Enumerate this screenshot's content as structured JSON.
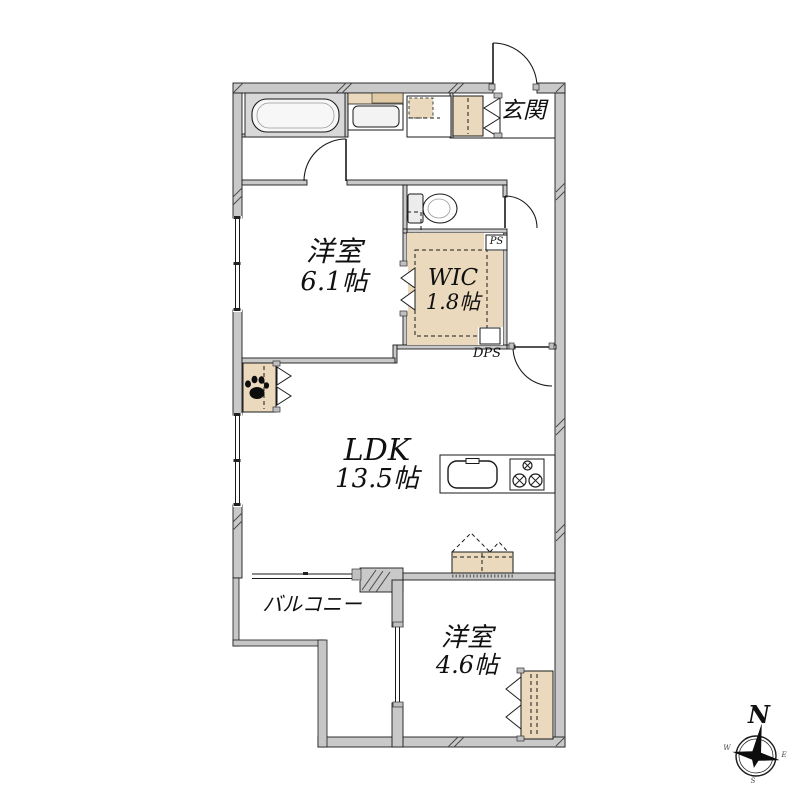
{
  "plan": {
    "type": "apartment-floor-plan",
    "entrance": {
      "label": "玄関"
    },
    "rooms": [
      {
        "id": "bedroom-1",
        "name": "洋室",
        "size": "6.1帖"
      },
      {
        "id": "walk-in-closet",
        "name": "WIC",
        "size": "1.8帖"
      },
      {
        "id": "ldk",
        "name": "LDK",
        "size": "13.5帖"
      },
      {
        "id": "bedroom-2",
        "name": "洋室",
        "size": "4.6帖"
      },
      {
        "id": "balcony",
        "name": "バルコニー",
        "size": ""
      }
    ],
    "ducts": {
      "ps": "PS",
      "dps": "DPS"
    },
    "compass": {
      "north": "N",
      "west": "W",
      "east": "E",
      "south": "S"
    },
    "fixtures": [
      "bathtub",
      "vanity-basin",
      "washing-machine-pan",
      "shoe-cabinet",
      "toilet",
      "kitchen-sink",
      "gas-stove",
      "pet-storage-paw",
      "storage-closet",
      "closet"
    ],
    "colors": {
      "wall_fill": "#c9c9c9",
      "closet_fill": "#ead9bc",
      "bath_fill": "#d8d8d8",
      "line": "#1a1a1a",
      "background": "#ffffff"
    }
  }
}
